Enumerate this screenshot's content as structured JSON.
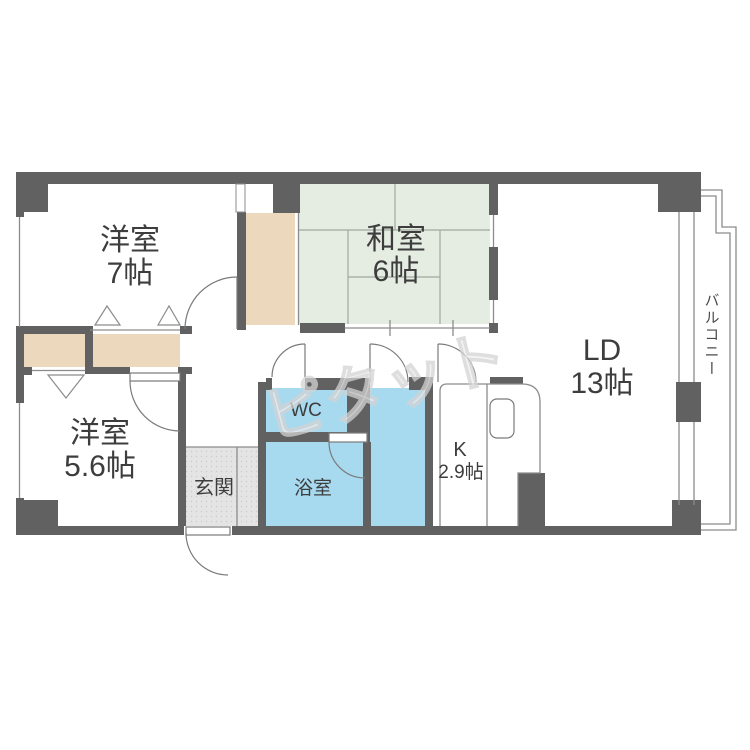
{
  "plan": {
    "rooms": {
      "western7": {
        "name": "洋室",
        "size": "7帖"
      },
      "japanese6": {
        "name": "和室",
        "size": "6帖"
      },
      "living": {
        "name": "LD",
        "size": "13帖"
      },
      "western56": {
        "name": "洋室",
        "size": "5.6帖"
      },
      "kitchen": {
        "name": "K",
        "size": "2.9帖"
      },
      "entrance": {
        "name": "玄関"
      },
      "toilet": {
        "name": "WC"
      },
      "bath": {
        "name": "浴室"
      },
      "balcony": {
        "name": "バルコニー"
      }
    },
    "watermark": "ピタット",
    "colors": {
      "wall": "#616161",
      "tatami": "#e5ede2",
      "closet": "#ebd8bd",
      "water": "#a8daef",
      "entrance_floor": "#e4e4e4",
      "outline": "#8c8c8c",
      "label": "#3d3d3d",
      "watermark": "#d9d9d9"
    }
  }
}
